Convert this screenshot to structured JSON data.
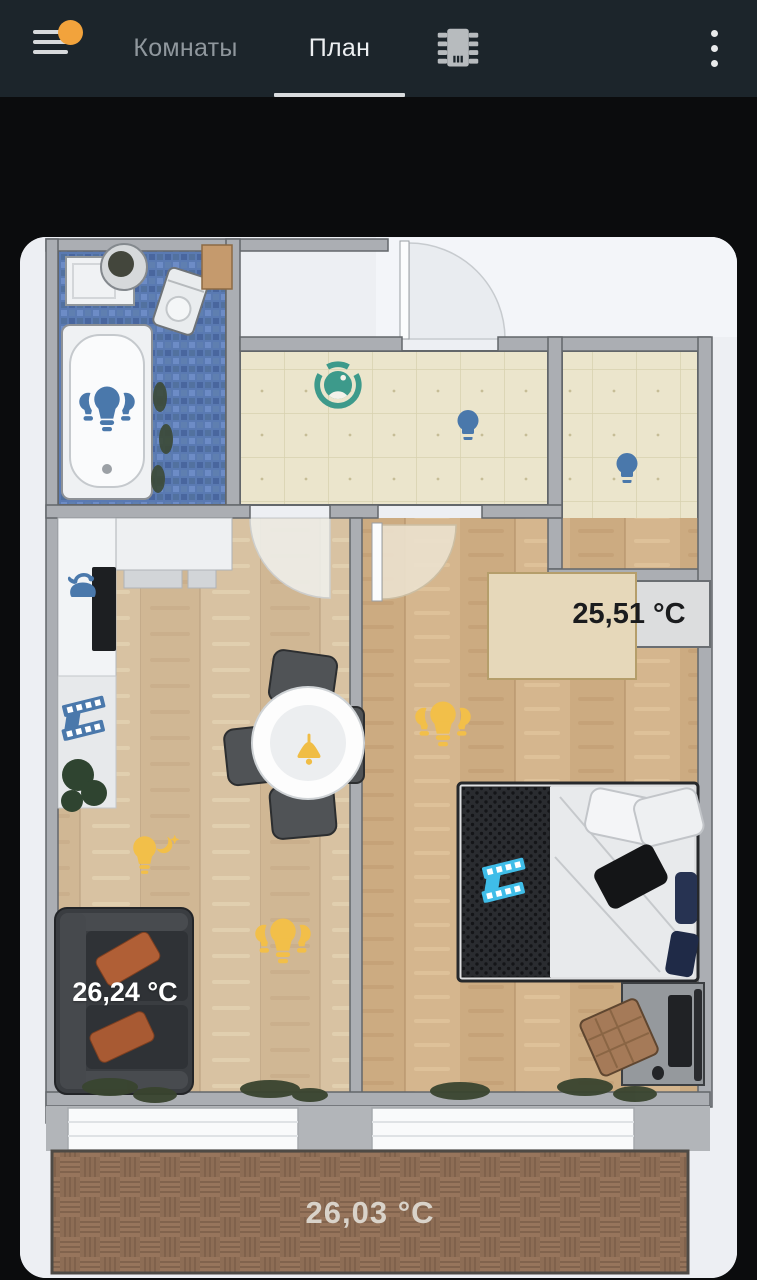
{
  "header": {
    "tabs": [
      {
        "label": "Комнаты"
      },
      {
        "label": "План"
      }
    ],
    "active_tab": "План",
    "icons": [
      "hamburger-menu-icon",
      "chip-icon",
      "kebab-menu-icon"
    ],
    "badge_color": "#f2a33c"
  },
  "plan": {
    "temperatures": {
      "closet": "25,51 °C",
      "living_room": "26,24 °C",
      "balcony": "26,03 °C"
    },
    "devices": [
      {
        "name": "bathroom-light-group",
        "type": "light-group",
        "color": "#4a78ab"
      },
      {
        "name": "hallway-vacuum",
        "type": "robot-vacuum",
        "color": "#3d9a8b"
      },
      {
        "name": "hallway-light",
        "type": "light",
        "color": "#4a78ab"
      },
      {
        "name": "closet-light",
        "type": "light",
        "color": "#4a78ab"
      },
      {
        "name": "kitchen-kettle",
        "type": "kettle",
        "color": "#4a78ab"
      },
      {
        "name": "kitchen-blinds",
        "type": "blinds",
        "color": "#4a78ab"
      },
      {
        "name": "dining-pendant-light",
        "type": "ceiling-light",
        "color": "#f2bf49"
      },
      {
        "name": "night-light",
        "type": "night-light",
        "color": "#f2bf49"
      },
      {
        "name": "living-room-light-group",
        "type": "light-group",
        "color": "#f2bf49"
      },
      {
        "name": "bedroom-light-group",
        "type": "light-group",
        "color": "#f2bf49"
      },
      {
        "name": "bedroom-blinds",
        "type": "blinds",
        "color": "#3fbde8"
      }
    ],
    "colors": {
      "device_blue": "#4a78ab",
      "device_yellow": "#f2bf49",
      "device_cyan": "#3fbde8",
      "vacuum_teal": "#3d9a8b",
      "header_bg": "#1c252b",
      "page_bg": "#0b0c0d"
    }
  }
}
